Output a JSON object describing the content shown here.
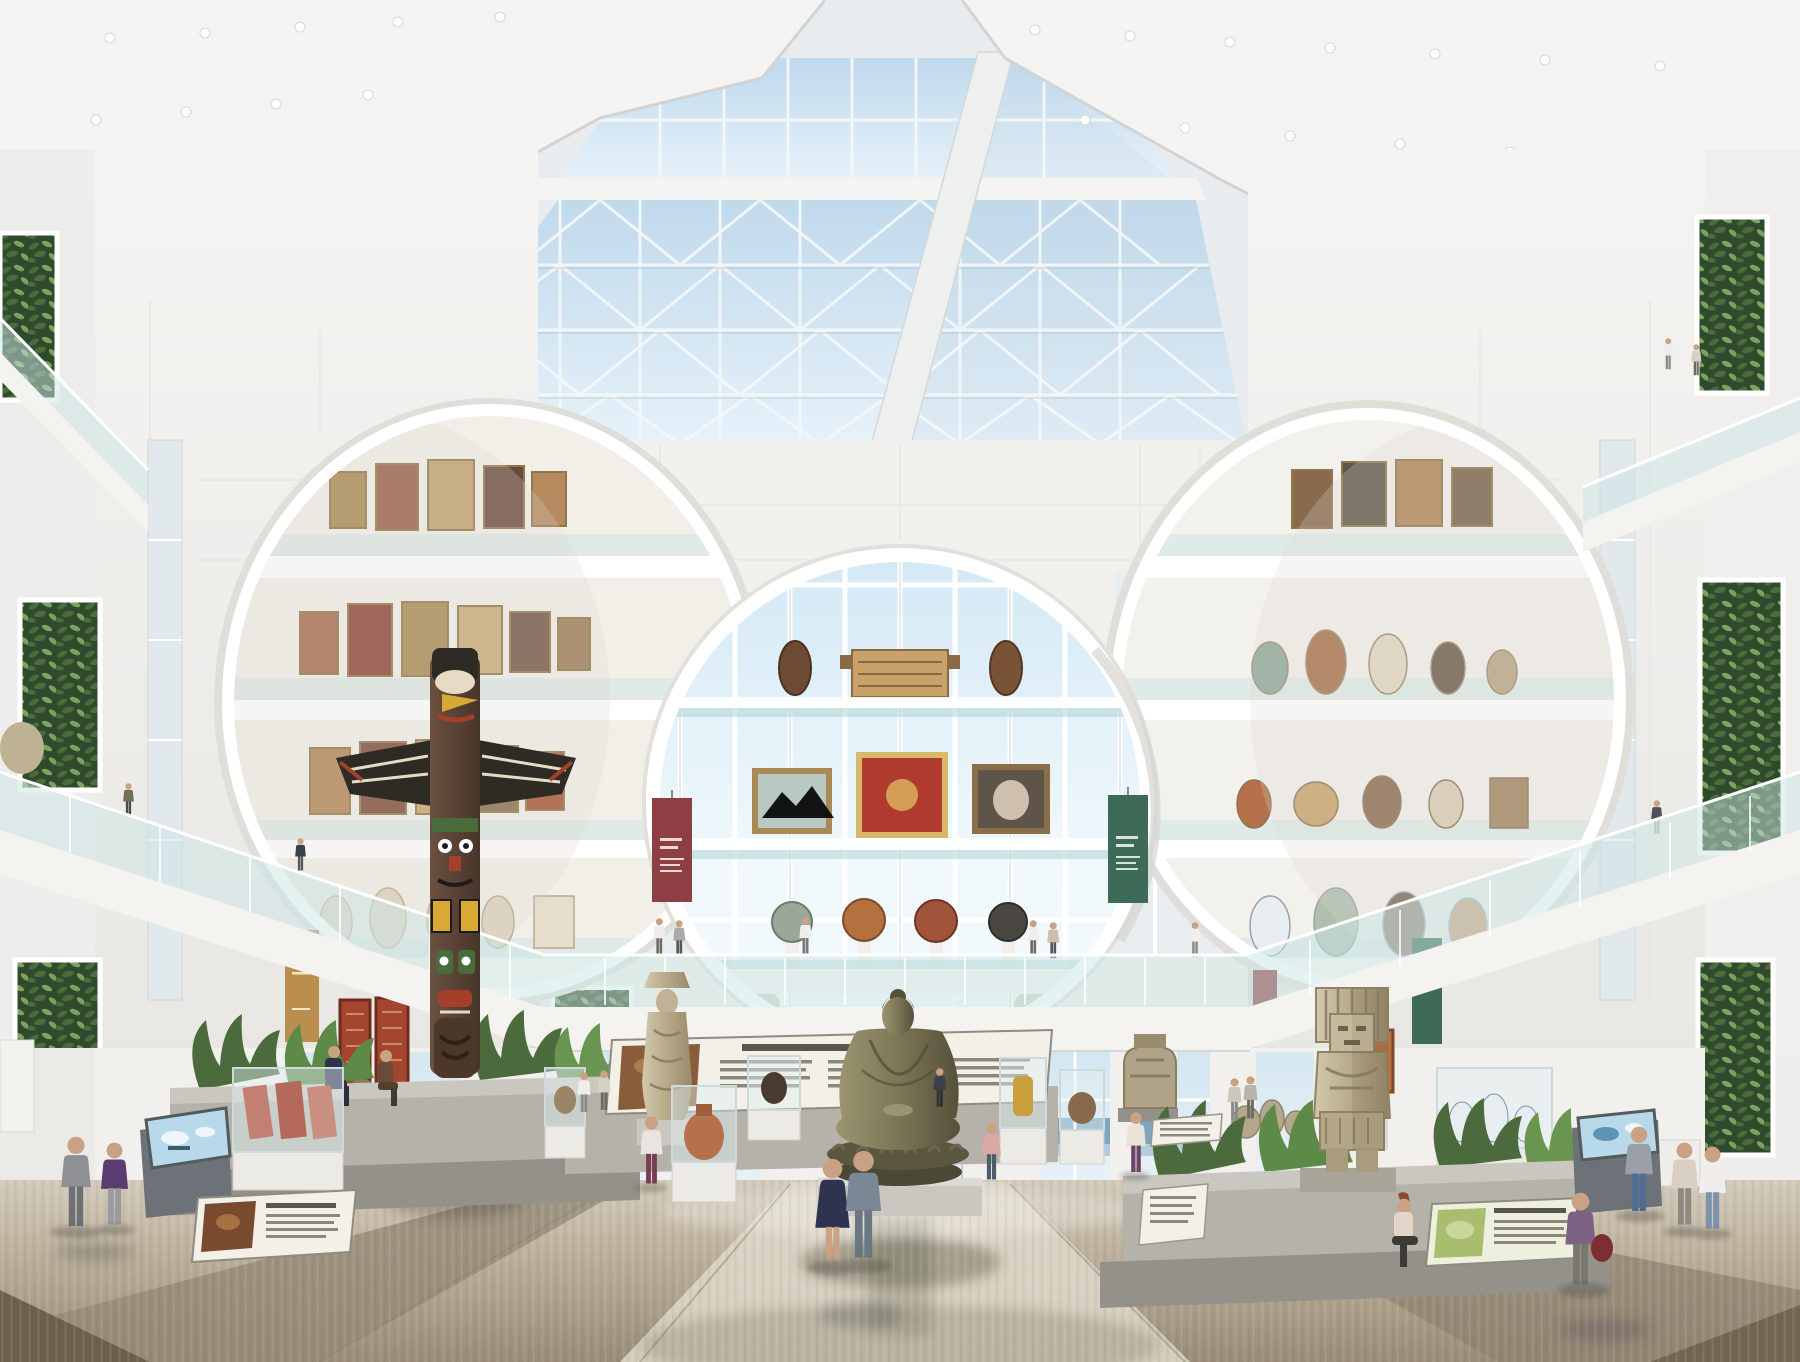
{
  "meta": {
    "title": "Museum atrium – photorealistic architectural rendering",
    "view": "interior atrium with skylight, circular gallery openings, living walls and exhibits"
  },
  "palette": {
    "sky": "#bfd9ec",
    "sky2": "#e7f2fa",
    "sky3": "#d3e8f5",
    "sea": "#7fa6c0",
    "seaLight": "#b3cddc",
    "ceiling": "#f4f4f2",
    "ceilingEdge": "#d2d4d4",
    "girder": "#eef0ef",
    "wall": "#f1f0ed",
    "wallShade": "#e6e4e0",
    "wallDark": "#d4d2cd",
    "gap": "#c9c7c2",
    "mullion": "#f4f7f8",
    "mullionDark": "#9fb0ba",
    "glass": "rgba(203,229,229,0.5)",
    "glassDeep": "rgba(176,212,214,0.55)",
    "glassLine": "rgba(255,255,255,0.85)",
    "fascia": "#f4f3f0",
    "fasciaShade": "#dddbd6",
    "foliage": "#4c6b3d",
    "foliageDark": "#2f4a2c",
    "foliageLight": "#7da25e",
    "floorA": "#d3cabb",
    "floorB": "#b7aa94",
    "floorC": "#9a8c76",
    "floorD": "#857867",
    "floorE": "#6c604c",
    "floorLight": "#ded7c9",
    "bannerRed": "#8e3f44",
    "bannerGreen": "#3e6b58",
    "bannerTan": "#b98e4f",
    "bannerMaroon": "#8c3a3e",
    "rug": "#a4452f",
    "rugDark": "#6e2c1e",
    "rugTan": "#c9a878",
    "rugGold": "#d9aa5c",
    "bronze": "#7c7656",
    "bronzeDark": "#55513a",
    "bronzeLight": "#9b9470",
    "stone": "#bfb294",
    "stoneDark": "#998a68",
    "stoneLight": "#d3c8ab",
    "wood": "#6b5140",
    "woodDark": "#46352a",
    "tBlack": "#2e2a24",
    "tGreen": "#4a6b3a",
    "tRed": "#a53f2a",
    "tYellow": "#d9a933",
    "tCream": "#e6dcc6",
    "concrete": "#b5b2aa",
    "concreteDark": "#94918a",
    "concreteLight": "#cac7c0",
    "kiosk": "#6d7178",
    "screen": "#b7d9e9",
    "screenInk": "#5f93b4",
    "frameGold": "#a98a52",
    "paper": "#f3f0e7",
    "ink": "#8b877c",
    "inkDark": "#5a564e",
    "greenPanel": "#a8bd6d",
    "greenPaper": "#eef0de",
    "skin": "#c9a183",
    "cSuit": "#8e9096",
    "cSuitLegs": "#6e7076",
    "cPurple": "#5b3c70",
    "cNavy": "#2e3450",
    "cWhite": "#efeeec",
    "cBeige": "#d9cfc2",
    "cJeans": "#7d93ab",
    "cMaroon": "#7c2f33",
    "cPink": "#d8a9a5",
    "cGray": "#a7a9ac",
    "cOlive": "#6f6f5a",
    "cDark": "#3a4048",
    "cLav": "#7d6285",
    "cTan": "#cdbfa9"
  },
  "labels": {
    "scene": "Museum atrium rendering",
    "ceiling": "White coffered ceiling with recessed downlights",
    "skylight": "Pyramidal glass skylight with white space-frame trusses and blue sky",
    "girder": "White diagonal roof girder",
    "walls": "White panelled atrium walls",
    "centerWindow": "Central circular curtain-wall window with glass artifact shelves",
    "leftGallery": "Left circular gallery opening with tiers of framed paintings",
    "rightGallery": "Right circular gallery opening with tiers of ceramics and busts",
    "livingWalls": "Vertical-garden living walls",
    "walkways": "Glass-railed balcony walkways with visitors",
    "bannerRed": "Maroon exhibition banner",
    "bannerGreen": "Green exhibition banner",
    "bannerTan": "Ochre exhibition banner",
    "tapestries": "Hanging ornamental rugs and tapestries",
    "groundWall": "Ground-floor glazing with ocean horizon beyond",
    "totem": "Carved and painted totem pole with outstretched wings",
    "buddha": "Monumental bronze seated Buddha on lotus plinth",
    "bodhisattva": "Standing stone bodhisattva figure",
    "aztec": "Monumental Aztec stone deity",
    "stoneDeity": "Aztec stone sculpture with crossed arms",
    "cases": "Glass display cases with artifacts",
    "kiosk": "Interactive touchscreen kiosk",
    "rails": "Angled interpretive reading panels",
    "planters": "Concrete planters with tropical plants and seated visitors",
    "floor": "Polished marble floor with reflections",
    "visitors": "Museum visitors"
  }
}
